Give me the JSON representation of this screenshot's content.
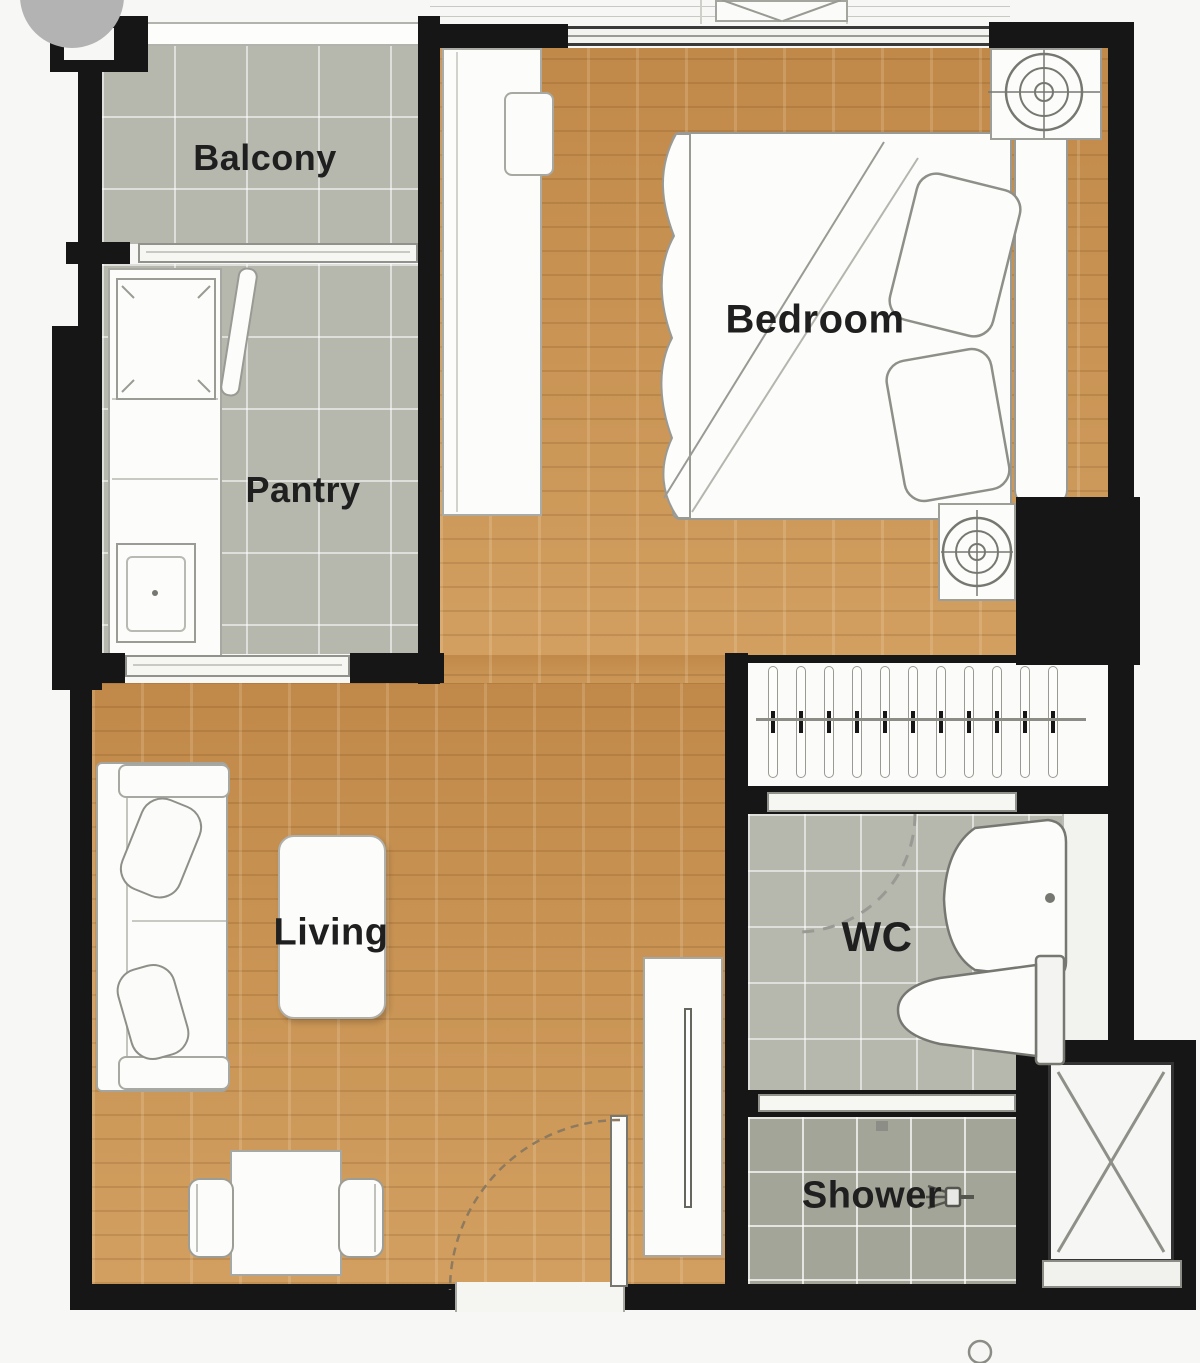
{
  "plan": {
    "type": "apartment-floor-plan",
    "rooms": {
      "balcony": "Balcony",
      "pantry": "Pantry",
      "bedroom": "Bedroom",
      "living": "Living",
      "wc": "WC",
      "shower": "Shower"
    },
    "colors": {
      "wall": "#161616",
      "tile_gray": "#b6b8ad",
      "shower_tile": "#a3a598",
      "wood_floor": "#c8914f",
      "furniture_white": "#fcfcfa",
      "label_text": "#1f1f1f",
      "watermark_gray": "#b3b3b3"
    }
  }
}
